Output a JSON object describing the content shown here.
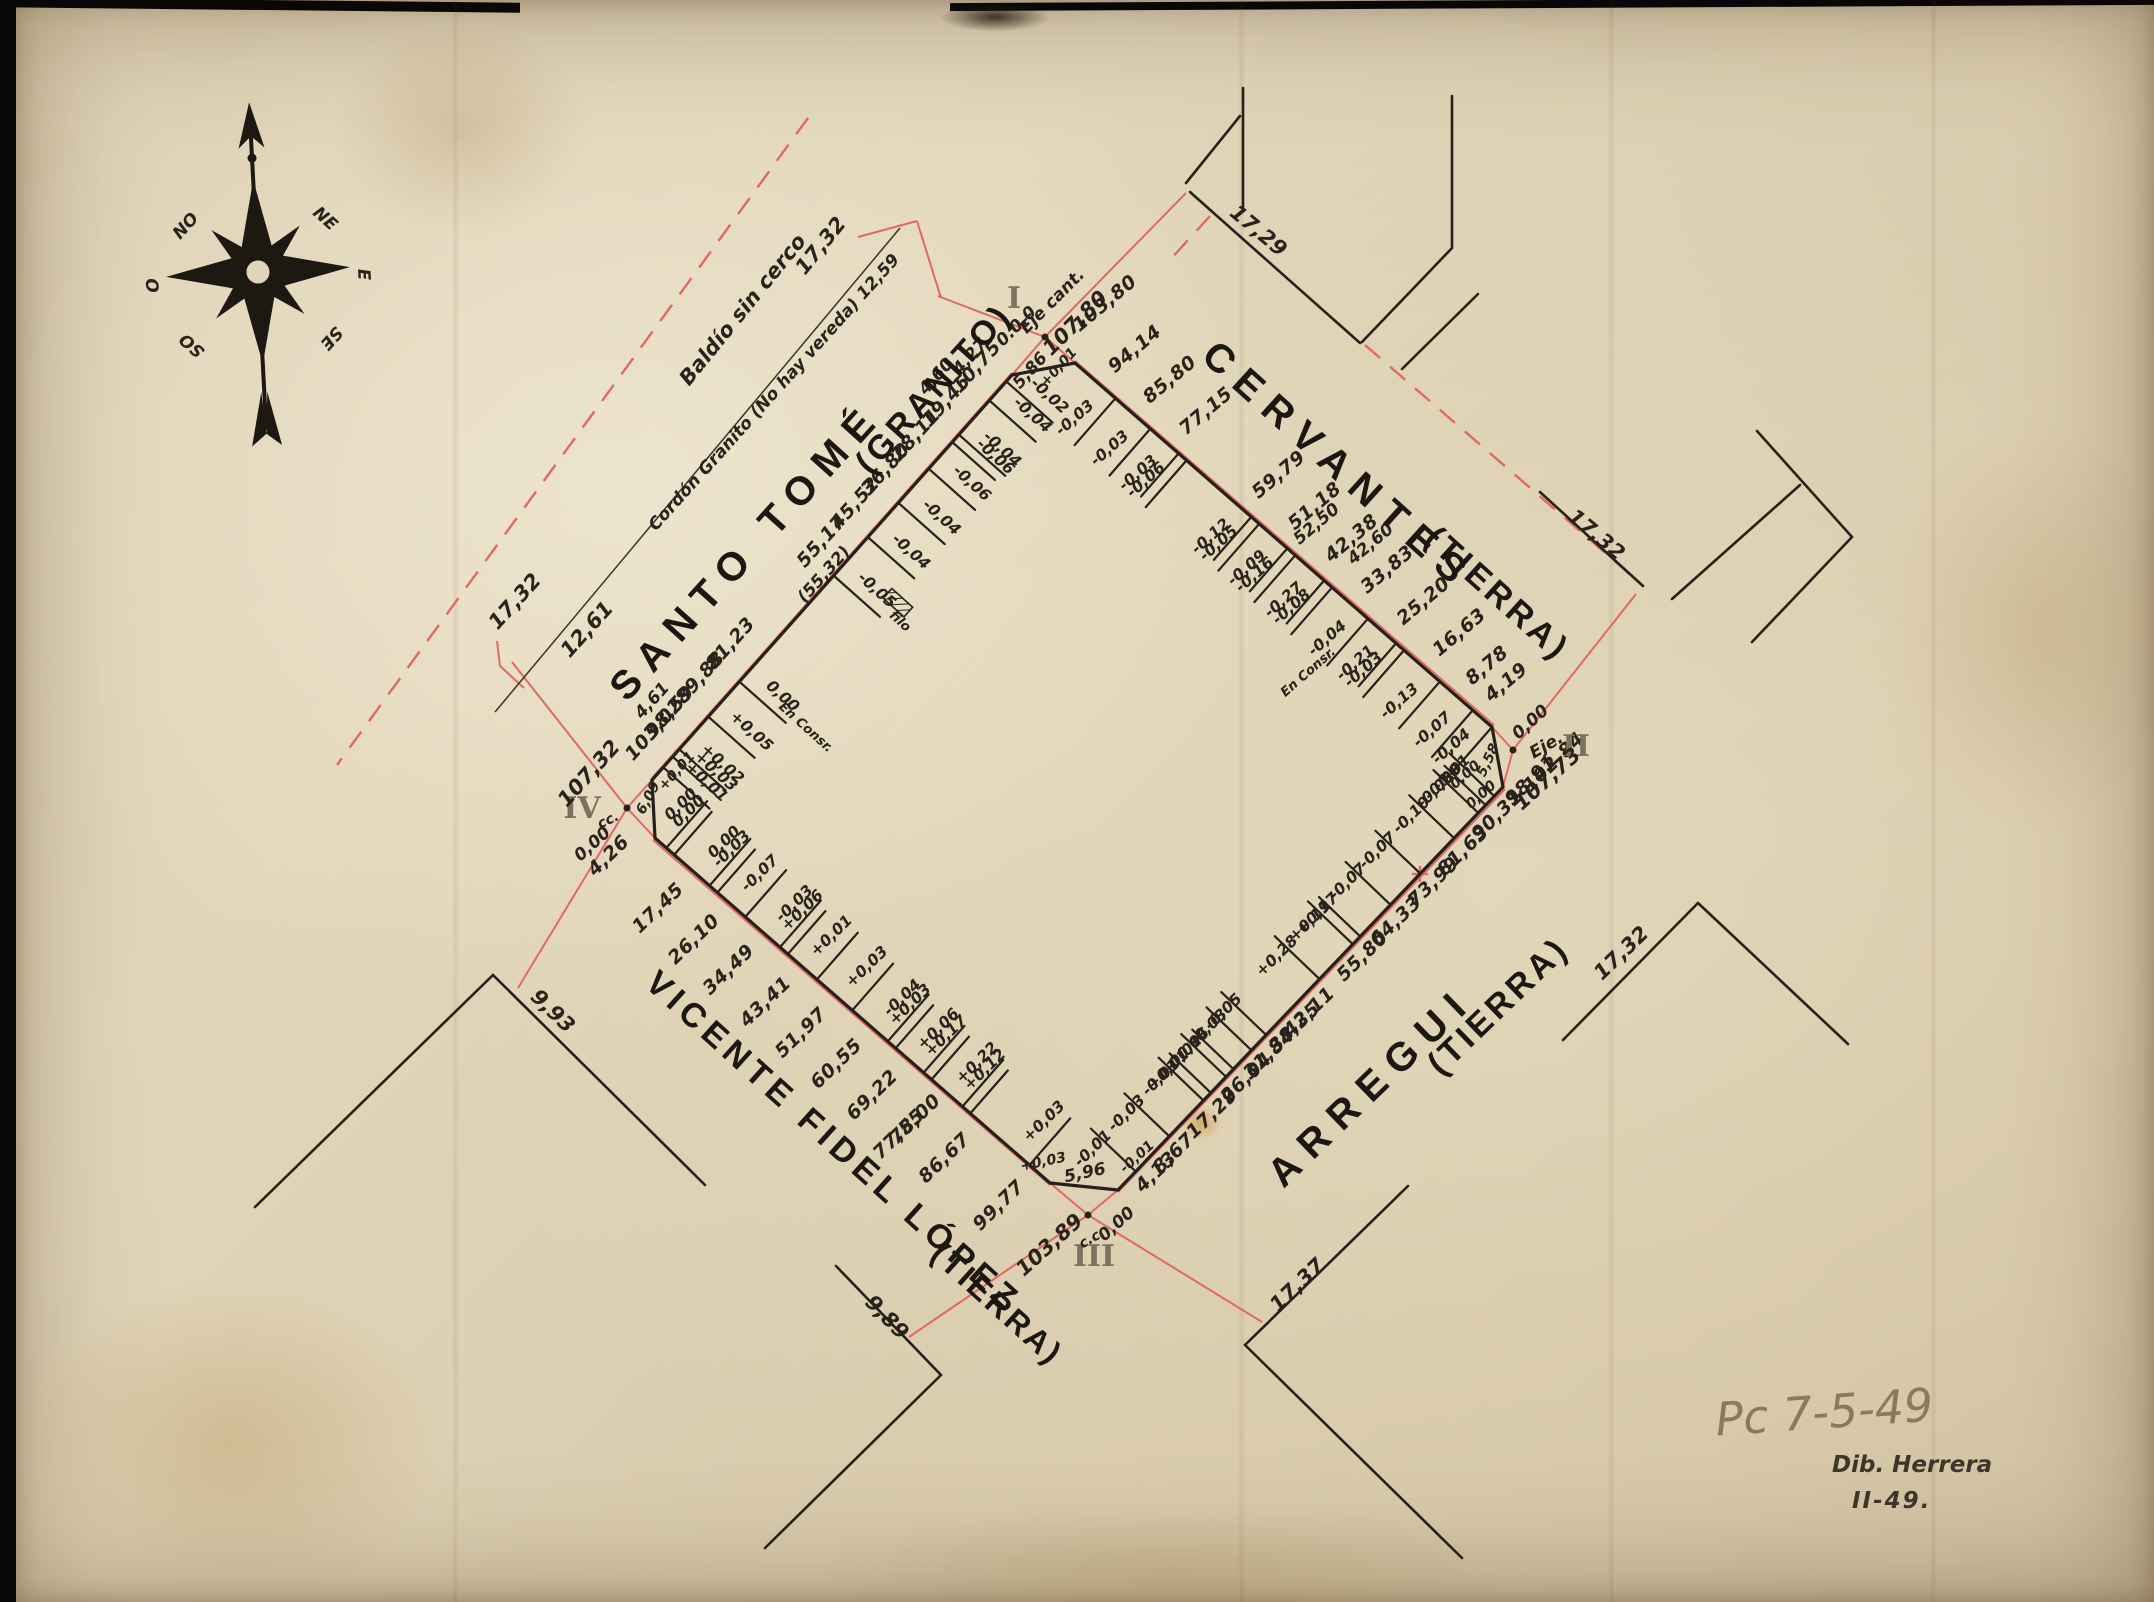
{
  "notes": {
    "pencil": "Pc  7-5-49",
    "dib": "Dib. Herrera",
    "dib_date": "II-49."
  },
  "compass": {
    "points": [
      "NO",
      "NE",
      "O",
      "E",
      "SO",
      "SE"
    ]
  },
  "streets": [
    {
      "id": "santo-tome",
      "name": "SANTO TOMÉ",
      "surface": "(GRANITO)"
    },
    {
      "id": "cervantes",
      "name": "CERVANTES",
      "surface": "(TIERRA)"
    },
    {
      "id": "vicente-fidel-lopez",
      "name": "VICENTE FIDEL LÓPEZ",
      "surface": "(TIERRA)"
    },
    {
      "id": "arregui",
      "name": "ARREGUI",
      "surface": "(TIERRA)"
    }
  ],
  "corners": [
    {
      "id": "I",
      "zero": "0.0.0",
      "axis": "Eje cant.",
      "total": "107,80",
      "ochava": "5,86"
    },
    {
      "id": "II",
      "zero": "0,00",
      "axis": "Eje.",
      "total": "107,73",
      "ochava": "5,58"
    },
    {
      "id": "III",
      "zero": "0,00",
      "axis": "c.c.",
      "total": "103,89",
      "ochava": "5,96"
    },
    {
      "id": "IV",
      "zero": "0,00",
      "axis": "cc.",
      "total": "107,32",
      "ochava": "6,09"
    }
  ],
  "edges": {
    "nw": {
      "street": "SANTO TOMÉ",
      "labels": [
        {
          "s": 10.75,
          "t": "10,75"
        },
        {
          "s": 19.45,
          "t": "19,45"
        },
        {
          "s": 28.11,
          "t": "28,11"
        },
        {
          "s": 36.8,
          "t": "36,80"
        },
        {
          "s": 45.52,
          "t": "45,52"
        },
        {
          "s": 55.17,
          "t": "55,17"
        },
        {
          "s": 81.23,
          "t": "81,23"
        },
        {
          "s": 89.88,
          "t": "89,88"
        },
        {
          "s": 98.59,
          "t": "98,59"
        },
        {
          "s": 103.02,
          "t": "103,02"
        }
      ],
      "ticks": [
        {
          "s": 5.9,
          "c": [
            "-0,02"
          ]
        },
        {
          "s": 10.75,
          "c": [
            "-0,04"
          ]
        },
        {
          "s": 19.45,
          "c": [
            "-0,04",
            "-0,06"
          ]
        },
        {
          "s": 28.11,
          "c": [
            "-0,06"
          ]
        },
        {
          "s": 36.8,
          "c": [
            "-0,04"
          ]
        },
        {
          "s": 45.52,
          "c": [
            "-0,04"
          ]
        },
        {
          "s": 55.32,
          "c": [
            "-0,05"
          ],
          "extra": "filo",
          "hatch": true
        },
        {
          "s": 82.3,
          "c": [
            "0,00"
          ],
          "extra": "En Consr."
        },
        {
          "s": 91.2,
          "c": [
            "+0,05"
          ]
        },
        {
          "s": 99.5,
          "c": [
            "+0,02",
            "+0,03"
          ]
        },
        {
          "s": 104.1,
          "c": [
            "+0,01"
          ]
        }
      ]
    },
    "ne": {
      "street": "CERVANTES",
      "labels": [
        {
          "s": 103.8,
          "t": "103,80",
          "d": 26
        },
        {
          "s": 94.14,
          "t": "94,14"
        },
        {
          "s": 85.8,
          "t": "85,80"
        },
        {
          "s": 77.15,
          "t": "77,15"
        },
        {
          "s": 59.79,
          "t": "59,79"
        },
        {
          "s": 51.18,
          "t": "51,18"
        },
        {
          "s": 42.38,
          "t": "42,38"
        },
        {
          "s": 33.83,
          "t": "33,83"
        },
        {
          "s": 25.2,
          "t": "25,20"
        },
        {
          "s": 16.63,
          "t": "16,63"
        },
        {
          "s": 8.78,
          "t": "8,78"
        },
        {
          "s": 4.19,
          "t": "4,19"
        }
      ],
      "ticks": [
        {
          "s": 94.14,
          "c": [
            "-0,03"
          ]
        },
        {
          "s": 85.8,
          "c": [
            "-0,03"
          ]
        },
        {
          "s": 77.15,
          "c": [
            "-0,06",
            "-0,03"
          ]
        },
        {
          "s": 59.79,
          "c": [
            "-0,05",
            "-0,12"
          ]
        },
        {
          "s": 51.18,
          "c": [
            "-0,16",
            "-0,09"
          ]
        },
        {
          "s": 42.38,
          "c": [
            "-0,08",
            "-0,27"
          ]
        },
        {
          "s": 33.83,
          "c": [
            "-0,04"
          ],
          "extra": "En Consr."
        },
        {
          "s": 25.2,
          "c": [
            "-0,03",
            "-0,21"
          ]
        },
        {
          "s": 16.63,
          "c": [
            "-0,13"
          ]
        },
        {
          "s": 8.78,
          "c": [
            "-0,07"
          ]
        },
        {
          "s": 4.19,
          "c": [
            "-0,04"
          ]
        }
      ]
    },
    "se": {
      "street": "ARREGUI",
      "labels": [
        {
          "s": 102.84,
          "t": "102,84",
          "d": 24
        },
        {
          "s": 98.91,
          "t": "98,91"
        },
        {
          "s": 90.31,
          "t": "90,31"
        },
        {
          "s": 81.63,
          "t": "81,63"
        },
        {
          "s": 73.99,
          "t": "73,99"
        },
        {
          "s": 64.33,
          "t": "64,33"
        },
        {
          "s": 55.8,
          "t": "55,80"
        },
        {
          "s": 42.11,
          "t": "42,11"
        },
        {
          "s": 38.35,
          "t": "38,35"
        },
        {
          "s": 31.84,
          "t": "31,84"
        },
        {
          "s": 26.04,
          "t": "26,04"
        },
        {
          "s": 17.29,
          "t": "17,29"
        },
        {
          "s": 8.67,
          "t": "8,67"
        },
        {
          "s": 4.13,
          "t": "4,13"
        }
      ],
      "ticks": [
        {
          "s": 100.6,
          "c": [
            "-0,01"
          ]
        },
        {
          "s": 96.5,
          "c": [
            "-0,03",
            "-0,08"
          ]
        },
        {
          "s": 90.31,
          "c": [
            "-0,10"
          ]
        },
        {
          "s": 81.63,
          "c": [
            "-0,07"
          ],
          "redcross": true
        },
        {
          "s": 73.99,
          "c": [
            "-0,07"
          ]
        },
        {
          "s": 64.33,
          "c": [
            "+0,19",
            "+0,17"
          ]
        },
        {
          "s": 55.8,
          "c": [
            "+0,28"
          ]
        },
        {
          "s": 42.11,
          "c": [
            "-0,05"
          ]
        },
        {
          "s": 38.35,
          "c": [
            "-0,03"
          ]
        },
        {
          "s": 31.84,
          "c": [
            "-0,01",
            "-0,06"
          ]
        },
        {
          "s": 26.04,
          "c": [
            "-0,01",
            "+0,01"
          ]
        },
        {
          "s": 17.29,
          "c": [
            "-0,03"
          ]
        },
        {
          "s": 8.67,
          "c": [
            "-0,01"
          ]
        }
      ]
    },
    "sw": {
      "street": "VICENTE FIDEL LÓPEZ",
      "labels": [
        {
          "s": 4.26,
          "t": "4,26"
        },
        {
          "s": 17.45,
          "t": "17,45"
        },
        {
          "s": 26.1,
          "t": "26,10"
        },
        {
          "s": 34.49,
          "t": "34,49"
        },
        {
          "s": 43.41,
          "t": "43,41"
        },
        {
          "s": 51.97,
          "t": "51,97"
        },
        {
          "s": 60.55,
          "t": "60,55"
        },
        {
          "s": 69.22,
          "t": "69,22"
        },
        {
          "s": 77.55,
          "t": "77,55",
          "d": 32
        },
        {
          "s": 78.0,
          "t": "78,00",
          "d": 10
        },
        {
          "s": 86.67,
          "t": "86,67"
        },
        {
          "s": 99.77,
          "t": "99,77"
        }
      ],
      "ticks": [
        {
          "s": 7.0,
          "c": [
            "0,00",
            "0,00"
          ]
        },
        {
          "s": 17.45,
          "c": [
            "0,00",
            "-0,03"
          ]
        },
        {
          "s": 26.1,
          "c": [
            "-0,07"
          ]
        },
        {
          "s": 34.49,
          "c": [
            "-0,03",
            "+0,06"
          ]
        },
        {
          "s": 43.41,
          "c": [
            "+0,01"
          ]
        },
        {
          "s": 51.97,
          "c": [
            "+0,03"
          ]
        },
        {
          "s": 60.55,
          "c": [
            "-0,04",
            "+0,03"
          ]
        },
        {
          "s": 69.22,
          "c": [
            "+0,06",
            "+0,17"
          ]
        },
        {
          "s": 78.6,
          "c": [
            "+0,22",
            "+0,12"
          ]
        },
        {
          "s": 94.8,
          "c": [
            "+0,03"
          ]
        }
      ]
    }
  },
  "annotations": [
    {
      "t": "I",
      "x": 1014,
      "y": 308,
      "rot": 0,
      "cls": "roman"
    },
    {
      "t": "0.0.0",
      "x": 1020,
      "y": 330,
      "rot": -45,
      "cls": "hand"
    },
    {
      "t": "Eje cant.",
      "x": 1056,
      "y": 305,
      "rot": -45,
      "cls": "hand"
    },
    {
      "t": "107,80",
      "x": 1080,
      "y": 328,
      "rot": -45,
      "cls": "handlg"
    },
    {
      "t": "5,86",
      "x": 1034,
      "y": 374,
      "rot": -48,
      "cls": "hand"
    },
    {
      "t": "+0,01",
      "x": 1062,
      "y": 370,
      "rot": -48,
      "cls": "handsm"
    },
    {
      "t": "4,27",
      "x": 974,
      "y": 360,
      "rot": -48,
      "cls": "hand"
    },
    {
      "t": "4,60",
      "x": 940,
      "y": 380,
      "rot": -48,
      "cls": "hand"
    },
    {
      "t": "II",
      "x": 1576,
      "y": 756,
      "rot": 0,
      "cls": "roman"
    },
    {
      "t": "0,00",
      "x": 1534,
      "y": 726,
      "rot": -42,
      "cls": "hand"
    },
    {
      "t": "Eje.",
      "x": 1549,
      "y": 750,
      "rot": -30,
      "cls": "hand"
    },
    {
      "t": "107,73",
      "x": 1552,
      "y": 784,
      "rot": -42,
      "cls": "handlg"
    },
    {
      "t": "5,58",
      "x": 1492,
      "y": 762,
      "rot": -65,
      "cls": "handsm"
    },
    {
      "t": "0,00",
      "x": 1468,
      "y": 778,
      "rot": -42,
      "cls": "handsm"
    },
    {
      "t": "0,00",
      "x": 1484,
      "y": 798,
      "rot": -42,
      "cls": "handsm"
    },
    {
      "t": "III",
      "x": 1094,
      "y": 1266,
      "rot": 0,
      "cls": "roman"
    },
    {
      "t": "0,00",
      "x": 1120,
      "y": 1228,
      "rot": -42,
      "cls": "hand"
    },
    {
      "t": "c.c.",
      "x": 1094,
      "y": 1242,
      "rot": -30,
      "cls": "handsm"
    },
    {
      "t": "103,89",
      "x": 1054,
      "y": 1250,
      "rot": -42,
      "cls": "handlg"
    },
    {
      "t": "5,96",
      "x": 1086,
      "y": 1178,
      "rot": -12,
      "cls": "hand"
    },
    {
      "t": "+0,03",
      "x": 1044,
      "y": 1166,
      "rot": -12,
      "cls": "handsm"
    },
    {
      "t": "-0,01",
      "x": 1140,
      "y": 1160,
      "rot": -42,
      "cls": "handsm"
    },
    {
      "t": "IV",
      "x": 582,
      "y": 818,
      "rot": 0,
      "cls": "roman"
    },
    {
      "t": "cc.",
      "x": 610,
      "y": 824,
      "rot": -25,
      "cls": "handsm"
    },
    {
      "t": "0,00",
      "x": 596,
      "y": 848,
      "rot": -42,
      "cls": "hand"
    },
    {
      "t": "107,32",
      "x": 594,
      "y": 778,
      "rot": -48,
      "cls": "handlg"
    },
    {
      "t": "6,09",
      "x": 652,
      "y": 800,
      "rot": -62,
      "cls": "handsm"
    },
    {
      "t": "+0,01",
      "x": 680,
      "y": 774,
      "rot": -48,
      "cls": "handsm"
    },
    {
      "t": "(55,32)",
      "x": 828,
      "y": 578,
      "rot": -48,
      "cls": "hand"
    },
    {
      "t": "4,61",
      "x": 656,
      "y": 704,
      "rot": -48,
      "cls": "hand"
    },
    {
      "t": "52,50",
      "x": 1320,
      "y": 528,
      "rot": -40,
      "cls": "hand"
    },
    {
      "t": "42,60",
      "x": 1374,
      "y": 548,
      "rot": -40,
      "cls": "hand"
    },
    {
      "t": "Baldío sin cerco",
      "x": 748,
      "y": 314,
      "rot": -51,
      "cls": "handlg"
    },
    {
      "t": "17,32",
      "x": 826,
      "y": 250,
      "rot": -51,
      "cls": "handlg"
    },
    {
      "t": "Cordón Granito (No hay vereda) 12,59",
      "x": 778,
      "y": 396,
      "rot": -48,
      "cls": "hand"
    },
    {
      "t": "17,32",
      "x": 520,
      "y": 606,
      "rot": -48,
      "cls": "handlg"
    },
    {
      "t": "12,61",
      "x": 592,
      "y": 634,
      "rot": -48,
      "cls": "handlg"
    },
    {
      "t": "17,29",
      "x": 1254,
      "y": 236,
      "rot": 40,
      "cls": "handlg"
    },
    {
      "t": "17,32",
      "x": 1592,
      "y": 540,
      "rot": 40,
      "cls": "handlg"
    },
    {
      "t": "17,32",
      "x": 1626,
      "y": 958,
      "rot": -44,
      "cls": "handlg"
    },
    {
      "t": "17,37",
      "x": 1302,
      "y": 1290,
      "rot": -44,
      "cls": "handlg"
    },
    {
      "t": "9,93",
      "x": 548,
      "y": 1016,
      "rot": 44,
      "cls": "handlg"
    },
    {
      "t": "9,89",
      "x": 882,
      "y": 1322,
      "rot": 46,
      "cls": "handlg"
    }
  ]
}
